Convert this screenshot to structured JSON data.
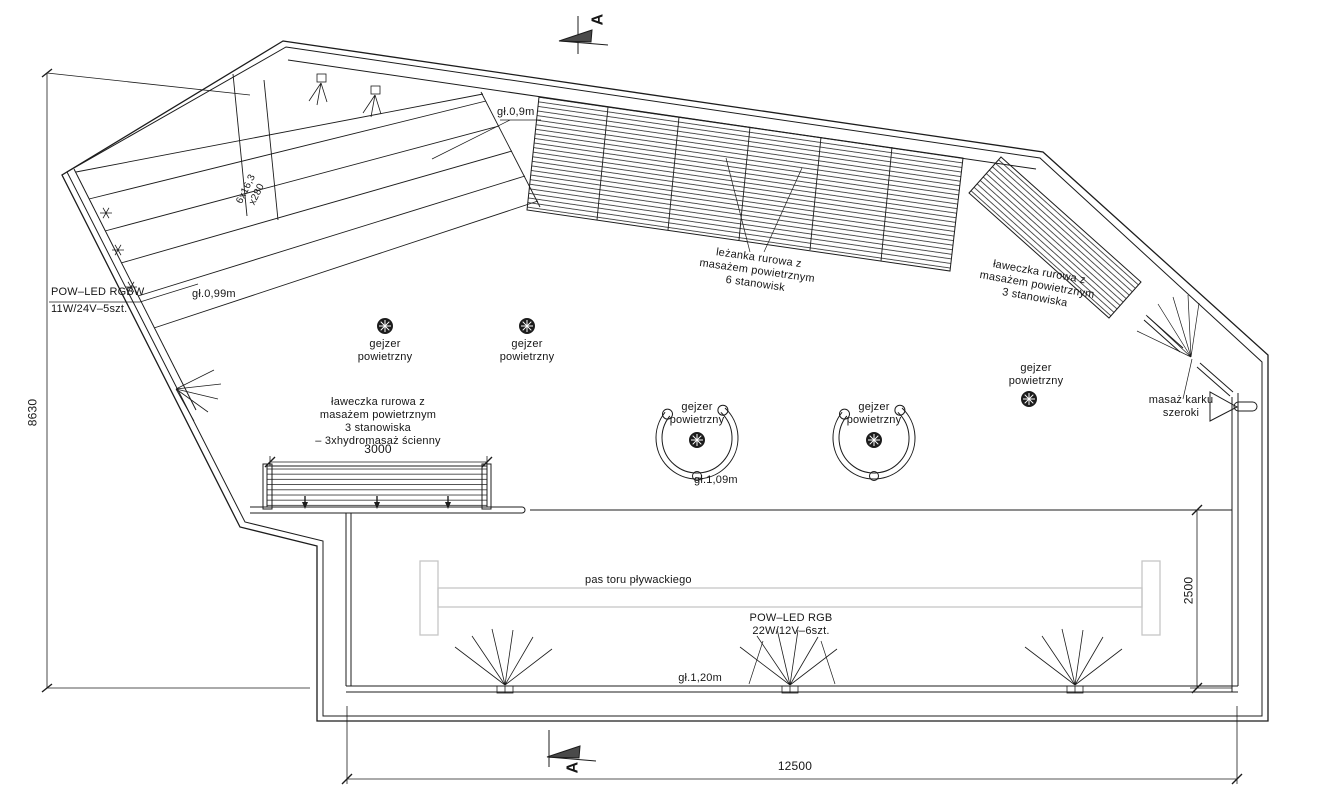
{
  "drawing": {
    "title": "pool-plan",
    "labels": {
      "depth_09": "gł.0,9m",
      "depth_099": "gł.0,99m",
      "depth_109": "gł.1,09m",
      "depth_120": "gł.1,20m",
      "stairs_note": "6x16,3\nx280",
      "led_rgbw": "POW–LED RGBW\n11W/24V–5szt.",
      "led_rgb": "POW–LED RGB\n22W/12V–6szt.",
      "lounger": "leżanka rurowa z\nmasażem powietrznym\n6 stanowisk",
      "bench_right": "ławeczka rurowa z\nmasażem powietrznym\n3 stanowiska",
      "bench_left": "ławeczka rurowa z\nmasażem powietrznym\n3 stanowiska\n– 3xhydromasaż ścienny",
      "geyser": "gejzer\npowietrzny",
      "neck_massage": "masaż karku\nszeroki",
      "swim_lane": "pas toru pływackiego",
      "section_marker": "A"
    },
    "dimensions": {
      "left_height": "8630",
      "bottom_width": "12500",
      "lane_width": "2500",
      "bench_length": "3000"
    },
    "colors": {
      "line": "#1c1c1c",
      "lane_marking": "#c6c6c6",
      "background": "#ffffff"
    }
  }
}
